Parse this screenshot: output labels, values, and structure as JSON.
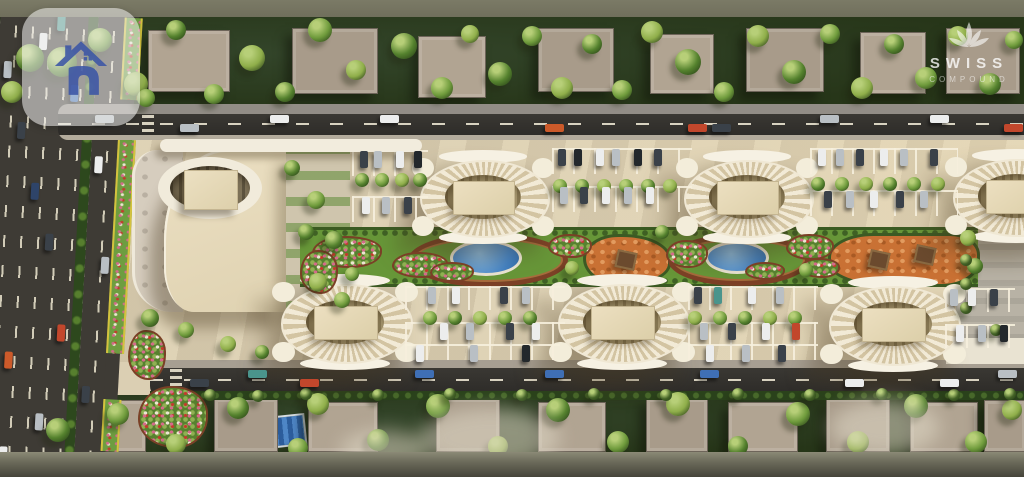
{
  "branding": {
    "watermark": {
      "line1": "SWISS",
      "line2": "COMPOUND"
    }
  },
  "colors": {
    "top_band": "#77765f",
    "ground_green": "#2b3a20",
    "asphalt": "#34322d",
    "compound_paving": "#dbcfb3",
    "building_cream": "#ecdfc0",
    "lawn_green": "#679638",
    "pool_blue": "#4585c8",
    "playground_orange": "#c97134",
    "path_brown": "#7c4026",
    "logo_blue": "#3c56a6"
  },
  "scene": {
    "car_colors": [
      "#eceded",
      "#b9bfc4",
      "#3a4149",
      "#c2472c",
      "#cc5a2a",
      "#3f6fb5",
      "#4a948c",
      "#23282c",
      "#2e4469"
    ],
    "tree_shades": [
      "#6f9b3c",
      "#55822e",
      "#8fae4a",
      "#436226"
    ],
    "oval_buildings": [
      [
        415,
        155,
        136,
        84
      ],
      [
        679,
        155,
        136,
        84
      ],
      [
        948,
        154,
        136,
        84
      ],
      [
        275,
        279,
        140,
        86
      ],
      [
        552,
        279,
        140,
        86
      ],
      [
        823,
        281,
        140,
        86
      ]
    ],
    "top_road_cars": [
      [
        95,
        0,
        1
      ],
      [
        180,
        1,
        1
      ],
      [
        270,
        0,
        0
      ],
      [
        380,
        0,
        0
      ],
      [
        545,
        1,
        4
      ],
      [
        688,
        1,
        3
      ],
      [
        712,
        1,
        2
      ],
      [
        820,
        0,
        1
      ],
      [
        930,
        0,
        0
      ],
      [
        1004,
        1,
        3
      ]
    ],
    "bottom_road_cars": [
      [
        190,
        1,
        2
      ],
      [
        248,
        0,
        6
      ],
      [
        300,
        1,
        3
      ],
      [
        415,
        0,
        5
      ],
      [
        545,
        0,
        5
      ],
      [
        700,
        0,
        5
      ],
      [
        845,
        1,
        0
      ],
      [
        940,
        1,
        0
      ],
      [
        998,
        0,
        1
      ]
    ],
    "highway_cars": [
      [
        6,
        70,
        1
      ],
      [
        23,
        130,
        2
      ],
      [
        40,
        40,
        0
      ],
      [
        40,
        190,
        8
      ],
      [
        57,
        240,
        2
      ],
      [
        6,
        300,
        7
      ],
      [
        23,
        360,
        4
      ],
      [
        57,
        420,
        1
      ],
      [
        74,
        90,
        5
      ],
      [
        74,
        330,
        3
      ],
      [
        102,
        160,
        0
      ],
      [
        114,
        260,
        1
      ],
      [
        102,
        390,
        2
      ],
      [
        23,
        455,
        0
      ],
      [
        57,
        20,
        6
      ]
    ],
    "parking_cars": [
      [
        360,
        151,
        2
      ],
      [
        374,
        151,
        1
      ],
      [
        396,
        151,
        0
      ],
      [
        414,
        151,
        7
      ],
      [
        362,
        197,
        0
      ],
      [
        382,
        197,
        1
      ],
      [
        404,
        197,
        2
      ],
      [
        558,
        149,
        2
      ],
      [
        574,
        149,
        7
      ],
      [
        596,
        149,
        0
      ],
      [
        612,
        149,
        1
      ],
      [
        634,
        149,
        7
      ],
      [
        654,
        149,
        2
      ],
      [
        560,
        187,
        1
      ],
      [
        580,
        187,
        2
      ],
      [
        602,
        187,
        0
      ],
      [
        624,
        187,
        1
      ],
      [
        646,
        187,
        0
      ],
      [
        818,
        149,
        0
      ],
      [
        836,
        149,
        1
      ],
      [
        856,
        149,
        2
      ],
      [
        880,
        149,
        0
      ],
      [
        900,
        149,
        1
      ],
      [
        930,
        149,
        2
      ],
      [
        824,
        191,
        2
      ],
      [
        846,
        191,
        1
      ],
      [
        870,
        191,
        0
      ],
      [
        896,
        191,
        2
      ],
      [
        920,
        191,
        1
      ],
      [
        428,
        287,
        1
      ],
      [
        452,
        287,
        0
      ],
      [
        500,
        287,
        2
      ],
      [
        522,
        287,
        1
      ],
      [
        440,
        323,
        0
      ],
      [
        466,
        323,
        1
      ],
      [
        506,
        323,
        2
      ],
      [
        532,
        323,
        0
      ],
      [
        416,
        345,
        0
      ],
      [
        470,
        345,
        1
      ],
      [
        522,
        345,
        7
      ],
      [
        694,
        287,
        2
      ],
      [
        714,
        287,
        6
      ],
      [
        748,
        287,
        0
      ],
      [
        776,
        287,
        1
      ],
      [
        700,
        323,
        1
      ],
      [
        728,
        323,
        2
      ],
      [
        762,
        323,
        0
      ],
      [
        792,
        323,
        3
      ],
      [
        706,
        345,
        0
      ],
      [
        742,
        345,
        1
      ],
      [
        778,
        345,
        2
      ],
      [
        950,
        289,
        1
      ],
      [
        968,
        289,
        0
      ],
      [
        990,
        289,
        2
      ],
      [
        956,
        325,
        0
      ],
      [
        978,
        325,
        1
      ],
      [
        1000,
        325,
        7
      ]
    ],
    "stall_rows": [
      [
        352,
        150,
        76,
        24
      ],
      [
        352,
        196,
        76,
        24
      ],
      [
        552,
        148,
        140,
        24
      ],
      [
        552,
        186,
        140,
        24
      ],
      [
        810,
        148,
        148,
        24
      ],
      [
        810,
        190,
        148,
        24
      ],
      [
        405,
        286,
        160,
        22
      ],
      [
        405,
        322,
        160,
        22
      ],
      [
        688,
        286,
        130,
        22
      ],
      [
        688,
        322,
        130,
        22
      ],
      [
        945,
        288,
        70,
        22
      ],
      [
        945,
        324,
        70,
        22
      ],
      [
        405,
        344,
        155,
        14
      ],
      [
        688,
        344,
        130,
        14
      ]
    ],
    "villas_top": [
      [
        148,
        30,
        80,
        60
      ],
      [
        292,
        28,
        84,
        64
      ],
      [
        418,
        36,
        66,
        60
      ],
      [
        538,
        28,
        74,
        62
      ],
      [
        650,
        34,
        62,
        58
      ],
      [
        746,
        28,
        76,
        62
      ],
      [
        860,
        32,
        64,
        60
      ],
      [
        946,
        28,
        72,
        64
      ]
    ],
    "villas_bottom": [
      [
        72,
        400,
        72,
        50
      ],
      [
        214,
        398,
        62,
        52
      ],
      [
        308,
        402,
        68,
        48
      ],
      [
        436,
        398,
        62,
        52
      ],
      [
        538,
        402,
        66,
        48
      ],
      [
        646,
        398,
        60,
        52
      ],
      [
        728,
        402,
        68,
        48
      ],
      [
        826,
        398,
        62,
        52
      ],
      [
        910,
        402,
        66,
        48
      ],
      [
        984,
        400,
        40,
        50
      ]
    ],
    "flowerbeds": [
      [
        312,
        236,
        66,
        28
      ],
      [
        392,
        252,
        52,
        22
      ],
      [
        548,
        234,
        40,
        20
      ],
      [
        666,
        240,
        38,
        24
      ],
      [
        786,
        234,
        44,
        22
      ],
      [
        800,
        258,
        36,
        16
      ],
      [
        430,
        262,
        40,
        16
      ],
      [
        745,
        262,
        36,
        14
      ],
      [
        300,
        250,
        34,
        40
      ],
      [
        128,
        330,
        34,
        46
      ],
      [
        138,
        386,
        66,
        58
      ]
    ],
    "trees": [
      [
        62,
        62,
        15,
        1
      ],
      [
        100,
        40,
        12,
        0
      ],
      [
        136,
        84,
        12,
        2
      ],
      [
        176,
        30,
        10,
        1
      ],
      [
        214,
        94,
        10,
        0
      ],
      [
        252,
        58,
        13,
        2
      ],
      [
        285,
        92,
        10,
        1
      ],
      [
        320,
        30,
        12,
        0
      ],
      [
        356,
        70,
        10,
        2
      ],
      [
        404,
        46,
        13,
        1
      ],
      [
        442,
        88,
        11,
        0
      ],
      [
        470,
        34,
        9,
        2
      ],
      [
        500,
        74,
        12,
        1
      ],
      [
        532,
        36,
        10,
        0
      ],
      [
        562,
        88,
        11,
        2
      ],
      [
        592,
        44,
        10,
        1
      ],
      [
        622,
        90,
        10,
        0
      ],
      [
        652,
        32,
        11,
        2
      ],
      [
        688,
        62,
        13,
        1
      ],
      [
        724,
        92,
        10,
        0
      ],
      [
        758,
        36,
        11,
        2
      ],
      [
        794,
        72,
        12,
        1
      ],
      [
        830,
        34,
        10,
        0
      ],
      [
        862,
        88,
        11,
        2
      ],
      [
        894,
        44,
        10,
        1
      ],
      [
        926,
        78,
        11,
        0
      ],
      [
        958,
        36,
        10,
        2
      ],
      [
        990,
        84,
        11,
        1
      ],
      [
        1014,
        40,
        9,
        0
      ],
      [
        30,
        58,
        14,
        1
      ],
      [
        12,
        92,
        11,
        2
      ],
      [
        146,
        98,
        9,
        0
      ],
      [
        292,
        168,
        8,
        1
      ],
      [
        316,
        200,
        9,
        0
      ],
      [
        334,
        240,
        9,
        1
      ],
      [
        318,
        282,
        9,
        2
      ],
      [
        342,
        300,
        8,
        0
      ],
      [
        362,
        180,
        7,
        1
      ],
      [
        382,
        180,
        7,
        0
      ],
      [
        402,
        180,
        7,
        2
      ],
      [
        420,
        180,
        7,
        1
      ],
      [
        560,
        186,
        7,
        0
      ],
      [
        582,
        186,
        7,
        1
      ],
      [
        604,
        186,
        7,
        2
      ],
      [
        626,
        186,
        7,
        0
      ],
      [
        648,
        186,
        7,
        1
      ],
      [
        670,
        186,
        7,
        2
      ],
      [
        818,
        184,
        7,
        1
      ],
      [
        842,
        184,
        7,
        0
      ],
      [
        866,
        184,
        7,
        2
      ],
      [
        890,
        184,
        7,
        1
      ],
      [
        914,
        184,
        7,
        0
      ],
      [
        938,
        184,
        7,
        2
      ],
      [
        430,
        318,
        7,
        0
      ],
      [
        455,
        318,
        7,
        1
      ],
      [
        480,
        318,
        7,
        2
      ],
      [
        505,
        318,
        7,
        0
      ],
      [
        530,
        318,
        7,
        1
      ],
      [
        695,
        318,
        7,
        2
      ],
      [
        720,
        318,
        7,
        0
      ],
      [
        745,
        318,
        7,
        1
      ],
      [
        770,
        318,
        7,
        2
      ],
      [
        795,
        318,
        7,
        0
      ],
      [
        306,
        232,
        8,
        1
      ],
      [
        352,
        274,
        7,
        0
      ],
      [
        572,
        268,
        7,
        2
      ],
      [
        662,
        232,
        7,
        1
      ],
      [
        806,
        270,
        7,
        0
      ],
      [
        968,
        238,
        8,
        2
      ],
      [
        975,
        266,
        8,
        1
      ],
      [
        150,
        318,
        9,
        1
      ],
      [
        186,
        330,
        8,
        0
      ],
      [
        228,
        344,
        8,
        2
      ],
      [
        262,
        352,
        7,
        1
      ],
      [
        966,
        260,
        6,
        3
      ],
      [
        966,
        284,
        6,
        3
      ],
      [
        966,
        308,
        6,
        3
      ],
      [
        996,
        330,
        6,
        3
      ],
      [
        58,
        430,
        12,
        1
      ],
      [
        118,
        414,
        11,
        0
      ],
      [
        176,
        444,
        10,
        2
      ],
      [
        238,
        408,
        11,
        1
      ],
      [
        298,
        448,
        10,
        0
      ],
      [
        318,
        404,
        11,
        2
      ],
      [
        378,
        440,
        11,
        1
      ],
      [
        438,
        406,
        12,
        0
      ],
      [
        498,
        446,
        10,
        2
      ],
      [
        558,
        410,
        12,
        1
      ],
      [
        618,
        442,
        11,
        0
      ],
      [
        678,
        404,
        12,
        2
      ],
      [
        738,
        446,
        10,
        1
      ],
      [
        798,
        414,
        12,
        0
      ],
      [
        858,
        442,
        11,
        2
      ],
      [
        916,
        406,
        12,
        1
      ],
      [
        976,
        442,
        11,
        0
      ],
      [
        1012,
        410,
        10,
        2
      ],
      [
        210,
        395,
        6,
        3
      ],
      [
        258,
        396,
        6,
        3
      ],
      [
        306,
        394,
        6,
        3
      ],
      [
        378,
        395,
        6,
        3
      ],
      [
        450,
        394,
        6,
        3
      ],
      [
        522,
        395,
        6,
        3
      ],
      [
        594,
        394,
        6,
        3
      ],
      [
        666,
        395,
        6,
        3
      ],
      [
        738,
        394,
        6,
        3
      ],
      [
        810,
        395,
        6,
        3
      ],
      [
        882,
        394,
        6,
        3
      ],
      [
        954,
        395,
        6,
        3
      ],
      [
        1010,
        394,
        6,
        3
      ]
    ],
    "hazes": [
      [
        420,
        408,
        140,
        60
      ],
      [
        830,
        400,
        110,
        55
      ],
      [
        340,
        430,
        90,
        40
      ]
    ]
  }
}
